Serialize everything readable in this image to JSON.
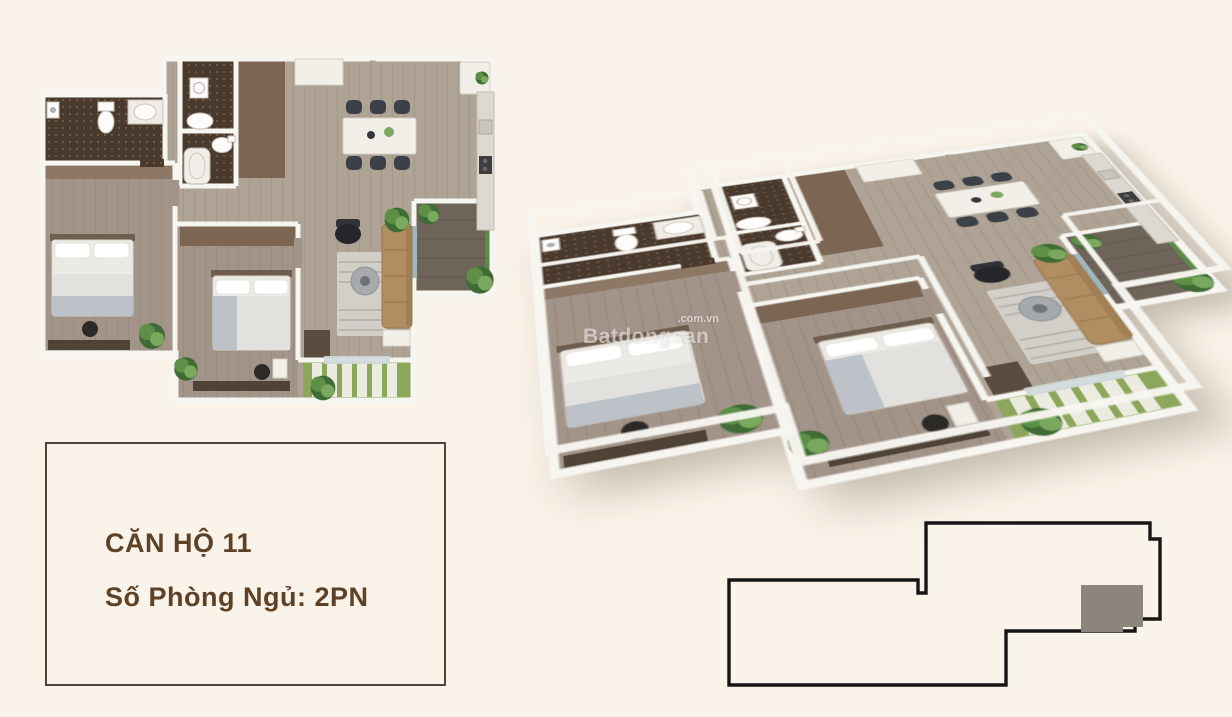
{
  "unit_card": {
    "title": "CĂN HỘ 11",
    "subtitle": "Số Phòng Ngủ: 2PN"
  },
  "watermark": {
    "main": "Batdongsan",
    "suffix": ".com.vn"
  },
  "palette": {
    "bg": "#faf3e9",
    "cardBorder": "#4e4536",
    "cardText": "#5d4227",
    "wood": "#aea395",
    "woodBed": "#a3948a",
    "woodDark": "#7c6553",
    "tile": "#4a392d",
    "tileDot": "#6f5b4a",
    "wall": "#f7f5f0",
    "deck": "#6e645a",
    "balcony": "#8ca65b",
    "slat": "#ecebe0",
    "green1": "#3f6b35",
    "green2": "#5d8f46",
    "green3": "#7aa85e",
    "sofa": "#b18e62",
    "rug": "#d2cfc8",
    "chairDark": "#3c4148",
    "grayBed": "#bcc2c8",
    "keyline": "#161616",
    "keymark": "#8b857c"
  }
}
